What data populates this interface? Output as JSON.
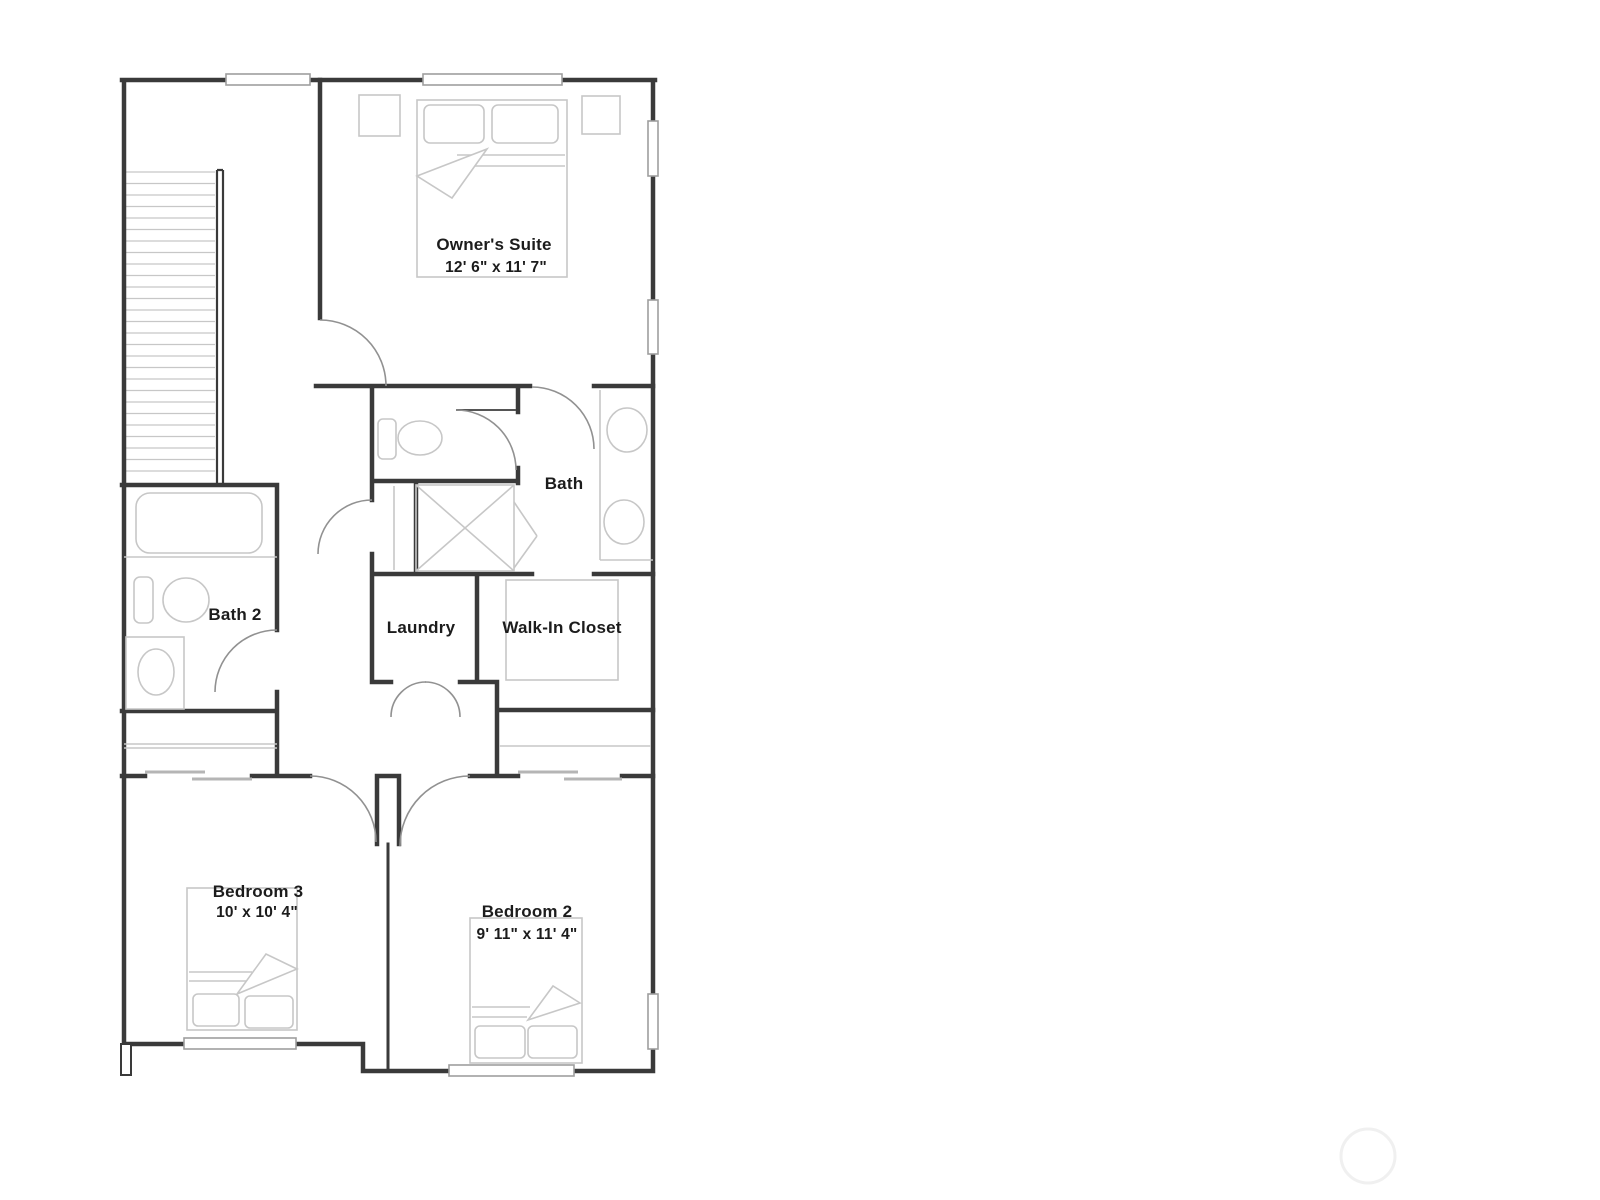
{
  "plan": {
    "type": "residential-floor-plan",
    "rooms": [
      {
        "id": "owners-suite",
        "name": "Owner's Suite",
        "dimensions": "12' 6\" x 11' 7\""
      },
      {
        "id": "bath",
        "name": "Bath",
        "dimensions": ""
      },
      {
        "id": "bath-2",
        "name": "Bath 2",
        "dimensions": ""
      },
      {
        "id": "laundry",
        "name": "Laundry",
        "dimensions": ""
      },
      {
        "id": "walk-in-closet",
        "name": "Walk-In Closet",
        "dimensions": ""
      },
      {
        "id": "bedroom-3",
        "name": "Bedroom 3",
        "dimensions": "10' x 10' 4\""
      },
      {
        "id": "bedroom-2",
        "name": "Bedroom 2",
        "dimensions": "9' 11\" x 11' 4\""
      }
    ],
    "fixtures": [
      "stairs",
      "bed",
      "nightstand",
      "toilet",
      "bathtub",
      "shower",
      "sink-vanity",
      "double-sink-vanity",
      "closet-shelves",
      "sliding-closet-doors",
      "washer-dryer-doors"
    ],
    "colors": {
      "wall": "#3a3a3a",
      "door_arc": "#919191",
      "fixture": "#c7c7c7",
      "window_border": "#9e9e9e",
      "text": "#1c1c1c",
      "watermark": "#f0f0f0",
      "background": "#ffffff"
    }
  }
}
